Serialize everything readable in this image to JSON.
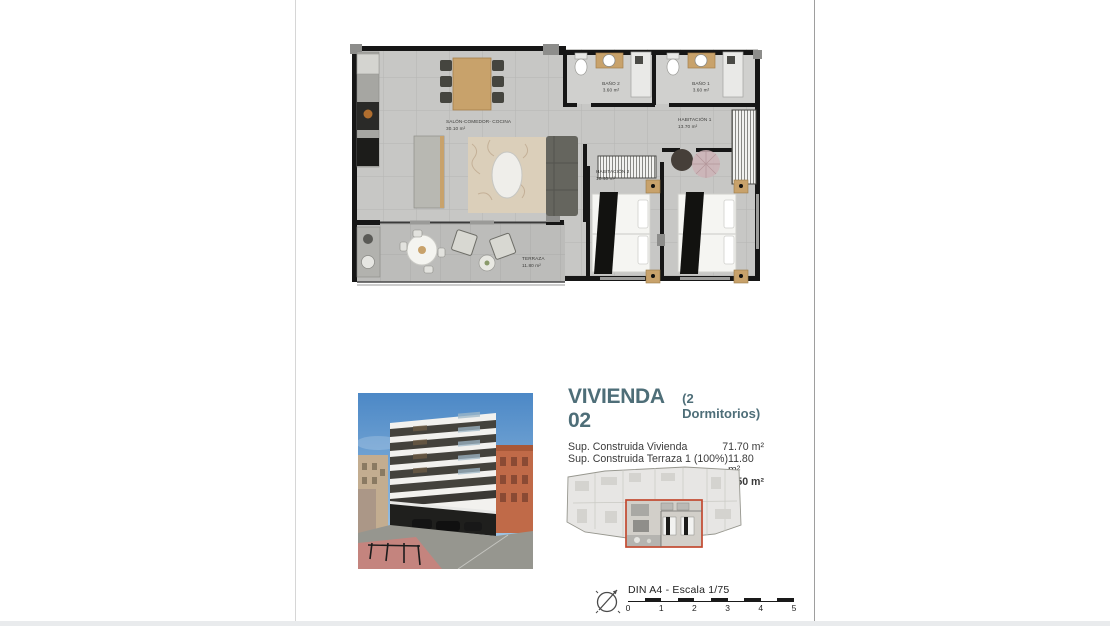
{
  "document": {
    "type": "architectural floor plan sheet",
    "accent_red": "#c2492f",
    "title_color": "#4e6e78"
  },
  "floor_plan": {
    "rooms": [
      {
        "name": "SALÓN-COMEDOR- COCINA",
        "area": "30.10 m²"
      },
      {
        "name": "BAÑO 2",
        "area": "3.60 m²"
      },
      {
        "name": "BAÑO 1",
        "area": "3.60 m²"
      },
      {
        "name": "HABITACIÓN 1",
        "area": "13.70 m²"
      },
      {
        "name": "HABITACIÓN 2",
        "area": "10.40 m²"
      },
      {
        "name": "TERRAZA",
        "area": "11.80 m²"
      }
    ]
  },
  "unit_info": {
    "title": "VIVIENDA 02",
    "subtitle": "(2 Dormitorios)",
    "rows": [
      {
        "prefix": "Sup. Construida Vivienda",
        "em": "",
        "value": "71.70 m²",
        "bold": false
      },
      {
        "prefix": "Sup. Construida Terraza 1 (100%)",
        "em": "",
        "value": "11.80 m²",
        "bold": false
      },
      {
        "prefix": "Sup. Construida ",
        "em": "TOTAL",
        "value": "83.50 m²",
        "bold": true
      }
    ]
  },
  "key_plan": {
    "description": "full floor key plan with unit highlighted",
    "highlight_color": "#c2492f"
  },
  "scale_bar": {
    "icon": "north-compass-icon",
    "label": "DIN A4 - Escala 1/75",
    "ticks": [
      "0",
      "1",
      "2",
      "3",
      "4",
      "5"
    ]
  }
}
